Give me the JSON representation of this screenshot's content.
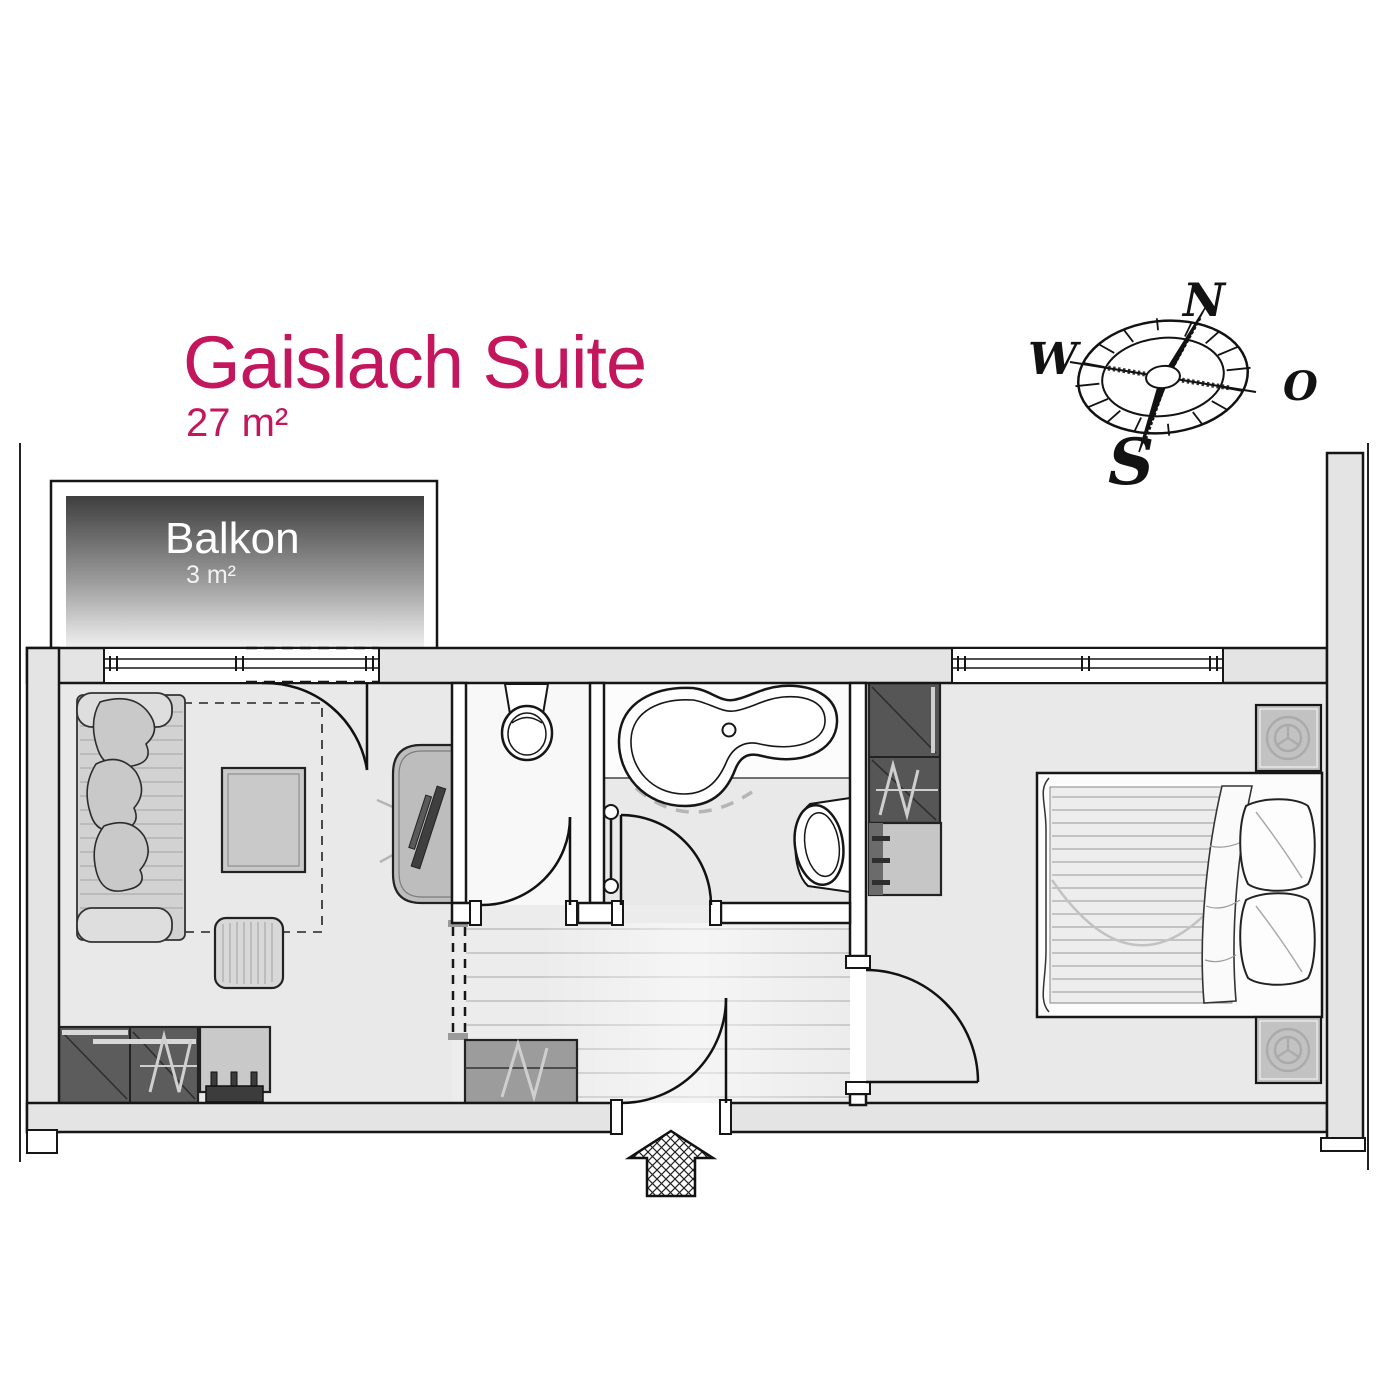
{
  "title": {
    "text": "Gaislach Suite",
    "area": "27 m²",
    "color": "#c4165c"
  },
  "balcony": {
    "label": "Balkon",
    "area": "3 m²"
  },
  "compass": {
    "n": "N",
    "w": "W",
    "o": "O",
    "s": "S"
  },
  "colors": {
    "accent": "#c4165c",
    "wall_fill": "#e4e4e4",
    "floor": "#e9e9e9",
    "dark_furniture": "#565656",
    "mid_furniture": "#c6c6c6",
    "line": "#161616"
  }
}
